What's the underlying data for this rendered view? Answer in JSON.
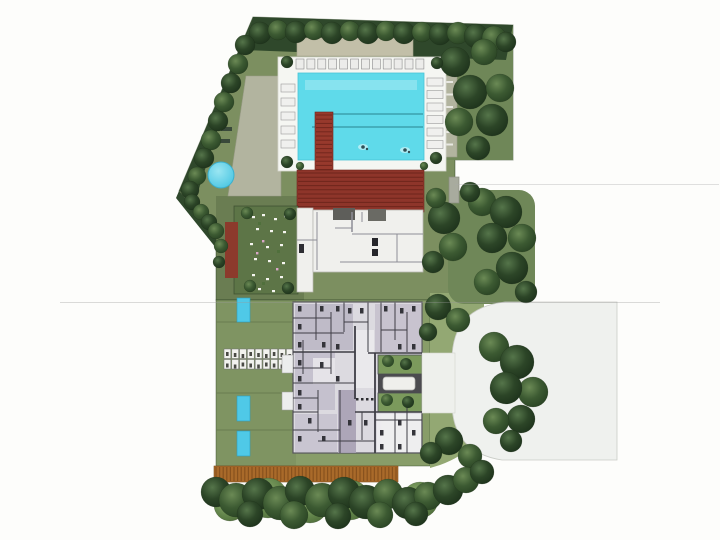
{
  "scene": {
    "type": "architectural-site-plan-rendering",
    "view": "top-down-aerial",
    "background_color": "#fdfdfb"
  },
  "palette": {
    "lawn_upper": "#7c8f60",
    "lawn_lower": "#889d69",
    "lawn_grove": "#6f8758",
    "lawn_se": "#93a873",
    "hedge": "#2f482b",
    "pool_water": "#5fdaea",
    "pool_deck": "#f5f6f2",
    "pergola_tan": "#c2bfa8",
    "pergola_side": "#b2b49f",
    "red_deck": "#8e352a",
    "red_walkway": "#97392c",
    "clubhouse": "#f0f0ed",
    "courtyard_garden": "#5d7547",
    "garden_red_deck": "#8c3a2c",
    "apartment_base": "#dcdae0",
    "apartment_lavender": "#b2acbe",
    "wall": "#3f3e46",
    "plunge_pool": "#4fc9e7",
    "fountain": "#54cfe8",
    "boardwalk": "#a96a2a",
    "driveway": "#eff1ee",
    "entry_pad": "#eef0ec",
    "inner_courtyard": "#7b9a5c",
    "corridor_dark": "#4b4b4f",
    "tree_dark": "#2c4527",
    "tree_mid": "#3c5a32",
    "tree_light": "#6f9350"
  },
  "elements": {
    "swimming_pool": {
      "lap_lane_lines": 2,
      "swimmers": 2
    },
    "pool_deck": {
      "sun_loungers_top_row": 12,
      "sun_loungers_left": 5,
      "sun_loungers_right": 6
    },
    "plunge_pools": {
      "count": 3
    },
    "lounger_grid": {
      "rows": 2,
      "cols": 9
    },
    "residential_building": {
      "inner_courtyards": 2,
      "courtyard_trees": 4
    },
    "spa_fountain": {
      "shape": "circle"
    }
  }
}
